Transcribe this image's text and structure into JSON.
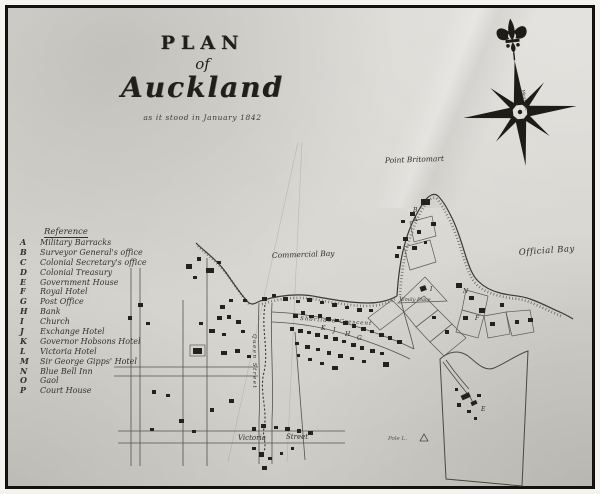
{
  "title": {
    "plan": "PLAN",
    "of": "of",
    "city": "Auckland",
    "subtitle": "as it stood in January 1842"
  },
  "compass": {
    "annotation": "Magnetic"
  },
  "reference": {
    "header": "Reference",
    "items": [
      {
        "letter": "A",
        "name": "Military Barracks"
      },
      {
        "letter": "B",
        "name": "Surveyor General's office"
      },
      {
        "letter": "C",
        "name": "Colonial Secretary's office"
      },
      {
        "letter": "D",
        "name": "Colonial Treasury"
      },
      {
        "letter": "E",
        "name": "Government House"
      },
      {
        "letter": "F",
        "name": "Royal Hotel"
      },
      {
        "letter": "G",
        "name": "Post Office"
      },
      {
        "letter": "H",
        "name": "Bank"
      },
      {
        "letter": "I",
        "name": "Church"
      },
      {
        "letter": "J",
        "name": "Exchange Hotel"
      },
      {
        "letter": "K",
        "name": "Governor Hobsons Hotel"
      },
      {
        "letter": "L",
        "name": "Victoria Hotel"
      },
      {
        "letter": "M",
        "name": "Sir George Gipps' Hotel"
      },
      {
        "letter": "N",
        "name": "Blue Bell Inn"
      },
      {
        "letter": "O",
        "name": "Gaol"
      },
      {
        "letter": "P",
        "name": "Court House"
      }
    ]
  },
  "places": {
    "point_britomart": "Point Britomart",
    "commercial_bay": "Commercial Bay",
    "official_bay": "Official Bay",
    "emily_place": "Emily Place",
    "shortland_crescent": "Shortland Crescent",
    "victoria_word": "Victoria",
    "street_word": "Street",
    "queen_street": "Queen Street",
    "pole_lane": "Pole L."
  },
  "map_marks": [
    {
      "t": "B"
    },
    {
      "t": "A"
    },
    {
      "t": "I"
    },
    {
      "t": "E"
    },
    {
      "t": "G"
    },
    {
      "t": "H"
    },
    {
      "t": "J"
    },
    {
      "t": "K"
    },
    {
      "t": "F"
    },
    {
      "t": "N"
    }
  ],
  "colors": {
    "ink": "#2e2d26",
    "building": "#23221c",
    "paper": "#d7d5d0",
    "frame": "#121210"
  }
}
